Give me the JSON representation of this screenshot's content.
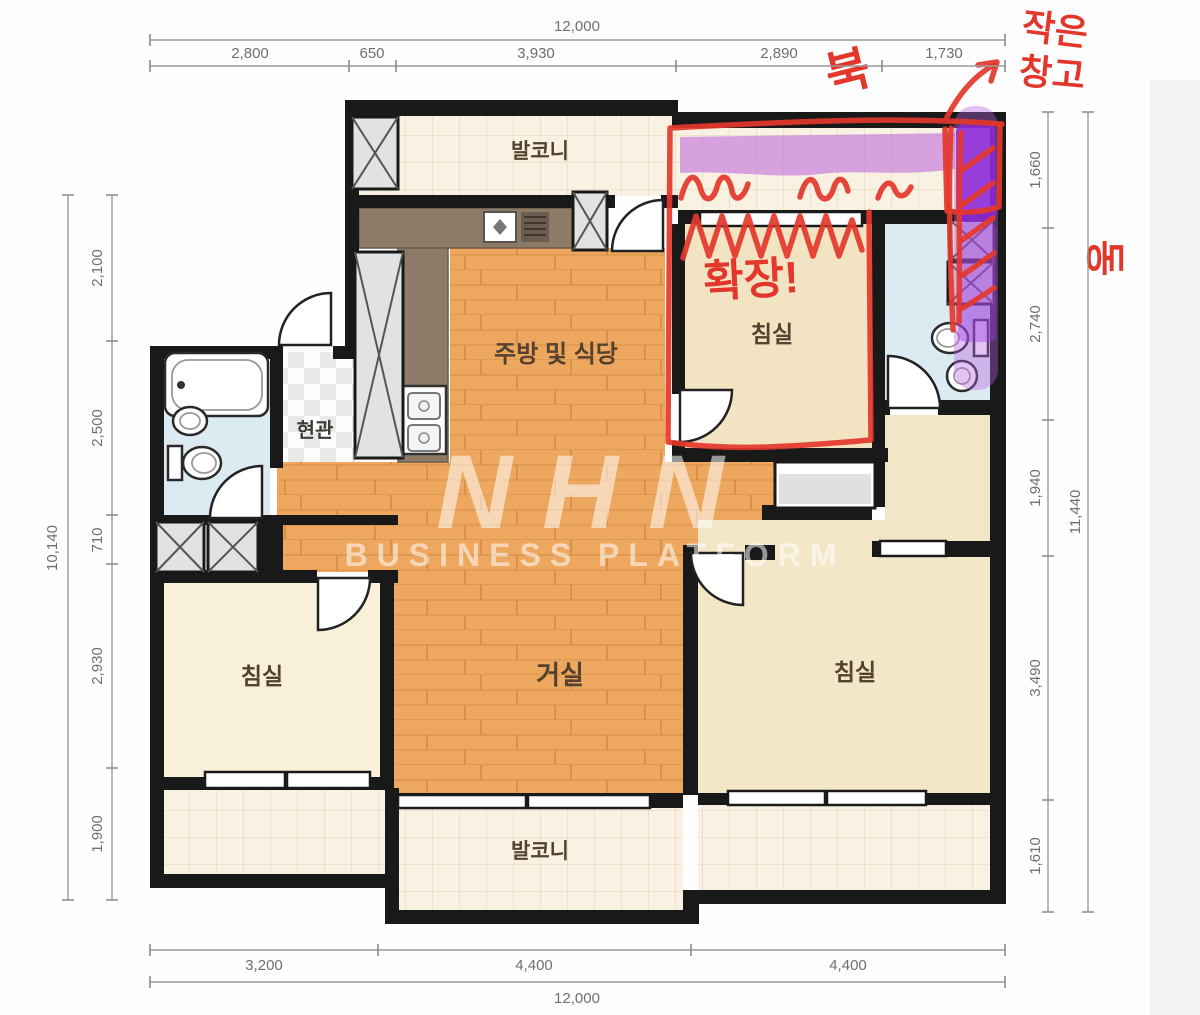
{
  "plan": {
    "rooms": {
      "balcony_top": "발코니",
      "balcony_bottom": "발코니",
      "kitchen_dining": "주방 및 식당",
      "bedroom_top": "침실",
      "bedroom_left": "침실",
      "bedroom_right": "침실",
      "entrance": "현관",
      "living": "거실"
    }
  },
  "dimensions": {
    "top": {
      "total": "12,000",
      "segments": [
        "2,800",
        "650",
        "3,930",
        "2,890",
        "1,730"
      ]
    },
    "bottom": {
      "total": "12,000",
      "segments": [
        "3,200",
        "4,400",
        "4,400"
      ]
    },
    "left": {
      "total": "10,140",
      "segments": [
        "2,100",
        "2,500",
        "710",
        "2,930",
        "1,900"
      ]
    },
    "right": {
      "total": "11,440",
      "segments": [
        "1,660",
        "2,740",
        "1,940",
        "3,490",
        "1,610"
      ]
    }
  },
  "annotations": {
    "north": "북",
    "east": "동",
    "small_storage_line1": "작은",
    "small_storage_line2": "창고",
    "expand": "확장!"
  },
  "watermark": {
    "line1": "NHN",
    "line2": "BUSINESS PLATFORM"
  },
  "colors": {
    "annotation_red": "#e4372b",
    "highlight_purple_deep": "#8b28d8",
    "highlight_purple_light": "#c06ce0",
    "wall": "#191919",
    "wood_floor": "#eda75e",
    "bedroom_floor": "#f2e3c2",
    "bathroom_floor": "#dcebf2",
    "balcony_tile": "#f9f1e1"
  }
}
